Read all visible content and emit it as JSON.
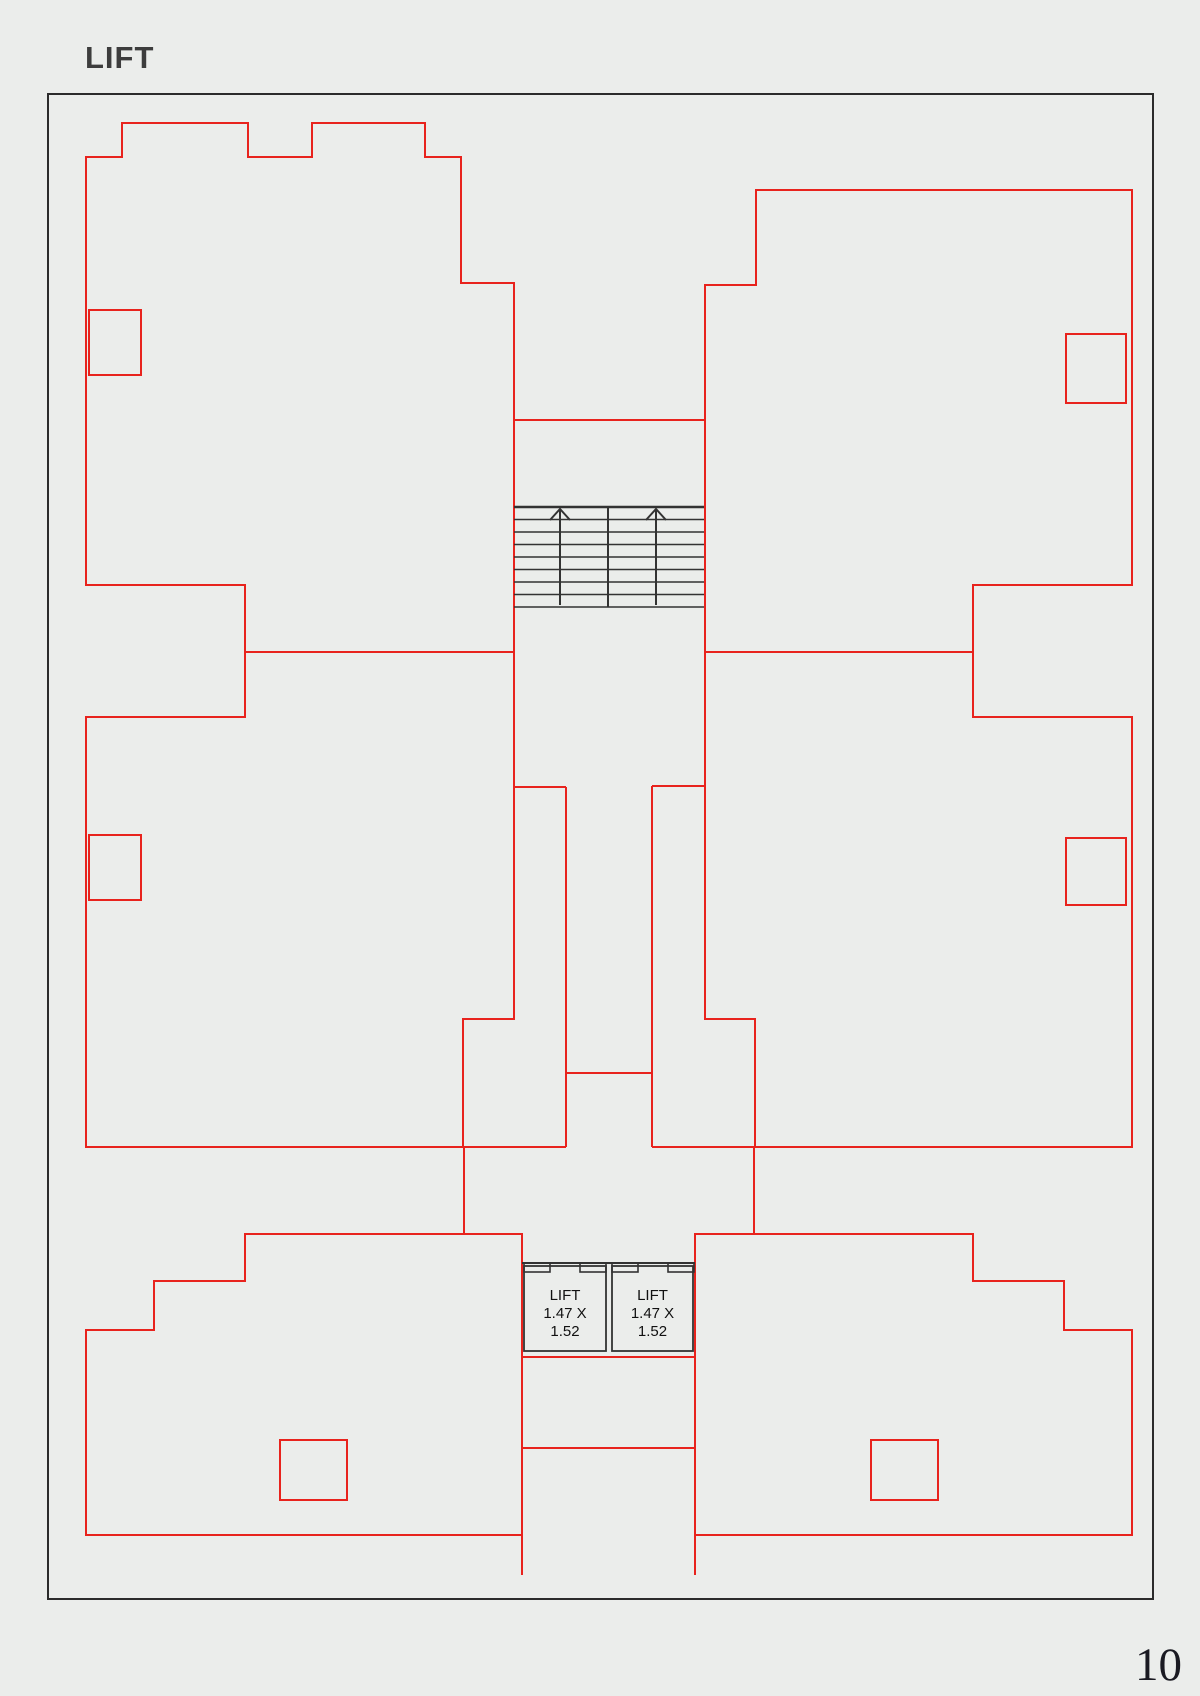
{
  "page": {
    "title": "LIFT",
    "page_number": "10",
    "background_color": "#ebedeb",
    "frame_color": "#2b2b2b",
    "red": "#e8231d",
    "black": "#333333",
    "label_color": "#111111"
  },
  "lifts": {
    "label_line1": "LIFT",
    "label_line2": "1.47 X",
    "label_line3": "1.52"
  },
  "plan": {
    "frame": [
      48,
      94,
      1105,
      1505
    ],
    "red_polygons": [
      {
        "name": "apartment-top-left",
        "points": [
          [
            86,
            157
          ],
          [
            122,
            157
          ],
          [
            122,
            123
          ],
          [
            248,
            123
          ],
          [
            248,
            157
          ],
          [
            312,
            157
          ],
          [
            312,
            123
          ],
          [
            425,
            123
          ],
          [
            425,
            157
          ],
          [
            461,
            157
          ],
          [
            461,
            283
          ],
          [
            514,
            283
          ],
          [
            514,
            652
          ],
          [
            245,
            652
          ],
          [
            245,
            585
          ],
          [
            86,
            585
          ]
        ]
      },
      {
        "name": "apartment-top-right",
        "points": [
          [
            756,
            190
          ],
          [
            1132,
            190
          ],
          [
            1132,
            585
          ],
          [
            973,
            585
          ],
          [
            973,
            652
          ],
          [
            705,
            652
          ],
          [
            705,
            285
          ],
          [
            756,
            285
          ]
        ]
      },
      {
        "name": "apartment-middle-left",
        "points": [
          [
            86,
            717
          ],
          [
            245,
            717
          ],
          [
            245,
            652
          ],
          [
            514,
            652
          ],
          [
            514,
            1019
          ],
          [
            463,
            1019
          ],
          [
            463,
            1147
          ],
          [
            86,
            1147
          ]
        ]
      },
      {
        "name": "apartment-middle-right",
        "points": [
          [
            1132,
            717
          ],
          [
            973,
            717
          ],
          [
            973,
            652
          ],
          [
            705,
            652
          ],
          [
            705,
            1019
          ],
          [
            755,
            1019
          ],
          [
            755,
            1147
          ],
          [
            1132,
            1147
          ]
        ]
      },
      {
        "name": "apartment-bottom-left",
        "points": [
          [
            522,
            1234
          ],
          [
            245,
            1234
          ],
          [
            245,
            1281
          ],
          [
            154,
            1281
          ],
          [
            154,
            1330
          ],
          [
            86,
            1330
          ],
          [
            86,
            1535
          ],
          [
            522,
            1535
          ]
        ]
      },
      {
        "name": "apartment-bottom-right",
        "points": [
          [
            695,
            1234
          ],
          [
            973,
            1234
          ],
          [
            973,
            1281
          ],
          [
            1064,
            1281
          ],
          [
            1064,
            1330
          ],
          [
            1132,
            1330
          ],
          [
            1132,
            1535
          ],
          [
            695,
            1535
          ]
        ]
      }
    ],
    "red_segments": [
      [
        514,
        420,
        705,
        420
      ],
      [
        514,
        787,
        566,
        787
      ],
      [
        566,
        787,
        566,
        1147
      ],
      [
        705,
        786,
        652,
        786
      ],
      [
        652,
        786,
        652,
        1147
      ],
      [
        566,
        1073,
        652,
        1073
      ],
      [
        463,
        1147,
        566,
        1147
      ],
      [
        652,
        1147,
        755,
        1147
      ],
      [
        464,
        1147,
        464,
        1234
      ],
      [
        754,
        1147,
        754,
        1234
      ],
      [
        522,
        1234,
        522,
        1575
      ],
      [
        695,
        1234,
        695,
        1575
      ],
      [
        522,
        1357,
        695,
        1357
      ],
      [
        522,
        1448,
        695,
        1448
      ]
    ],
    "red_rects": [
      {
        "name": "duct-top-left",
        "rect": [
          89,
          310,
          52,
          65
        ]
      },
      {
        "name": "duct-top-right",
        "rect": [
          1066,
          334,
          60,
          69
        ]
      },
      {
        "name": "duct-middle-left",
        "rect": [
          89,
          835,
          52,
          65
        ]
      },
      {
        "name": "duct-middle-right",
        "rect": [
          1066,
          838,
          60,
          67
        ]
      },
      {
        "name": "duct-bottom-left",
        "rect": [
          280,
          1440,
          67,
          60
        ]
      },
      {
        "name": "duct-bottom-right",
        "rect": [
          871,
          1440,
          67,
          60
        ]
      }
    ],
    "stairs": {
      "x1": 514,
      "x2": 704,
      "tread_top": 507,
      "tread_count": 9,
      "tread_step": 12.5,
      "divider_x": 608,
      "arrows": [
        560,
        656
      ],
      "arrow_bottom": 605,
      "arrow_tip": 509,
      "arrow_leg_dx": 10,
      "arrow_leg_dy": 11
    },
    "lift_block": {
      "wall_y": 1263,
      "wall_x1": 522,
      "wall_x2": 695,
      "tab_h": 9,
      "tabs": [
        [
          524,
          26
        ],
        [
          580,
          26
        ],
        [
          612,
          26
        ],
        [
          668,
          26
        ]
      ],
      "boxes": [
        [
          524,
          1266,
          82,
          85
        ],
        [
          612,
          1266,
          81,
          85
        ]
      ],
      "label_centers": [
        565,
        652.5
      ],
      "label_top": 1300,
      "label_line_h": 18,
      "label_font": 15
    }
  }
}
